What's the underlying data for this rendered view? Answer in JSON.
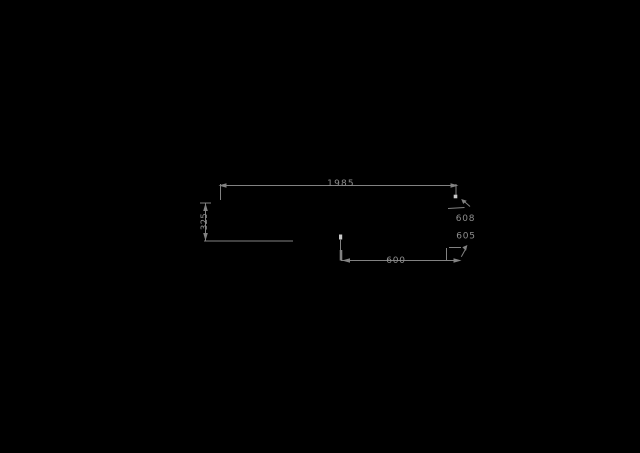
{
  "palette": {
    "bg": "#000000",
    "line": "#828282",
    "text": "#8e8e8e",
    "grip": "#c9c9c9"
  },
  "dimensions": {
    "top_width": {
      "value": "1985"
    },
    "left_height": {
      "value": "325"
    },
    "right_upper": {
      "value": "608"
    },
    "right_lower": {
      "value": "605"
    },
    "bottom_width": {
      "value": "600"
    }
  }
}
